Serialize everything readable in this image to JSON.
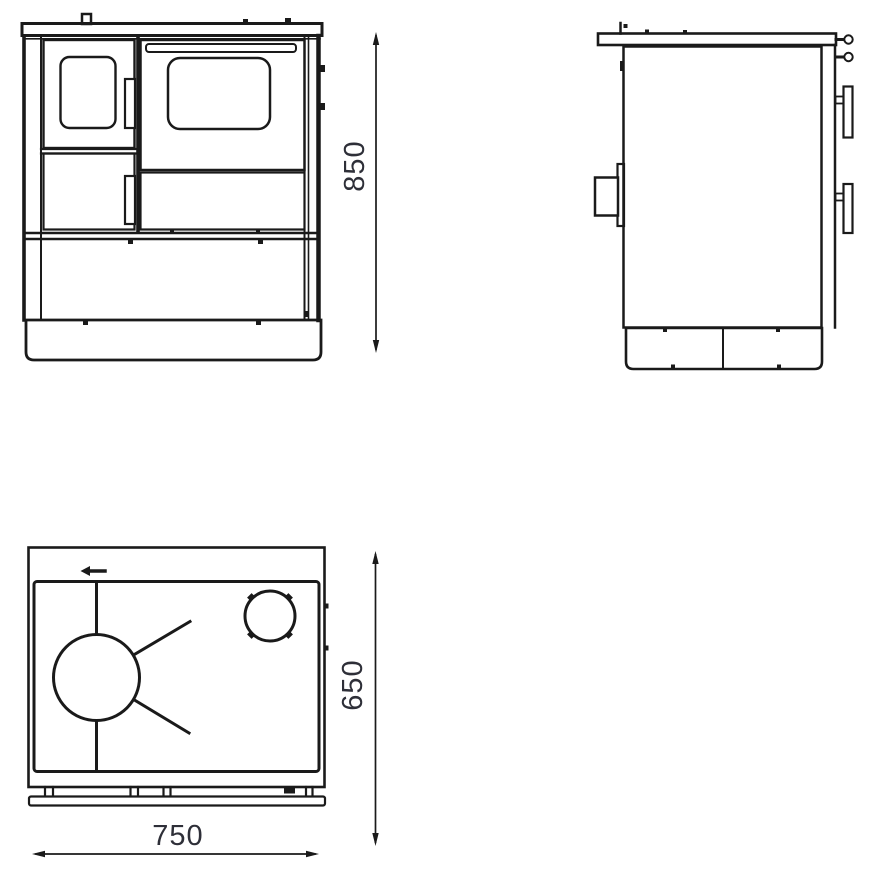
{
  "drawing": {
    "background_color": "#ffffff",
    "line_color": "#1a1a1a",
    "dimension_text_color": "#2e2f38"
  },
  "dimensions": {
    "height": "850",
    "depth": "650",
    "width": "750"
  },
  "icons": {
    "flue_direction_arrow": "◄"
  }
}
